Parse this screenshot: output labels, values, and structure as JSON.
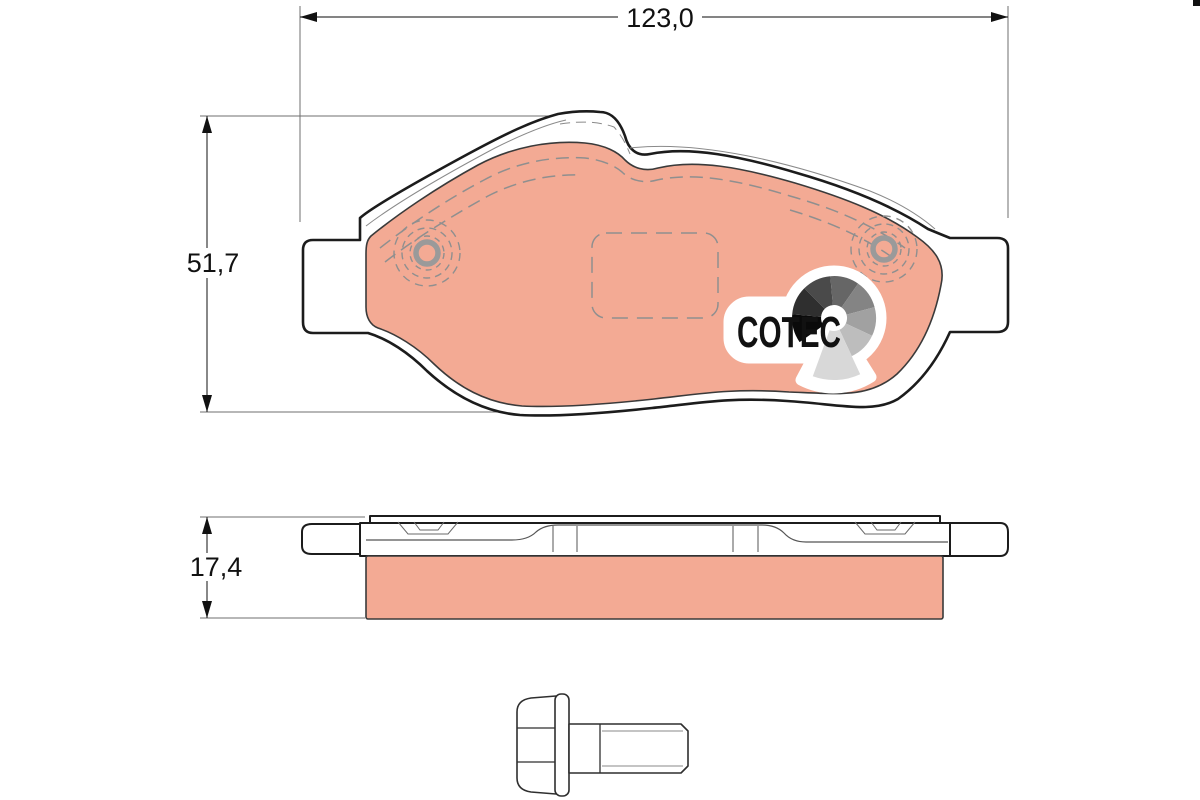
{
  "dimensions": {
    "width": "123,0",
    "height": "51,7",
    "thickness": "17,4"
  },
  "logo": {
    "text": "COTEC",
    "fan_colors": [
      "#0a0a0a",
      "#2f2f2f",
      "#4a4a4a",
      "#666666",
      "#848484",
      "#a1a1a1",
      "#bdbdbd",
      "#d8d8d8"
    ]
  },
  "colors": {
    "friction": "#f3aa94",
    "outline": "#1c1c1c",
    "detail_dash": "#8f8f8f",
    "background": "#ffffff"
  }
}
